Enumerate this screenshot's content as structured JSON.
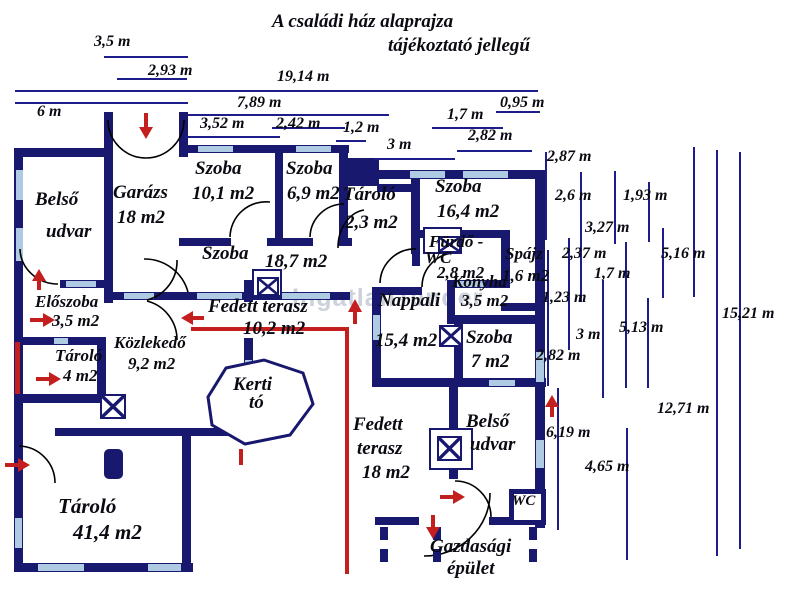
{
  "title": {
    "line1": "A családi ház alaprajza",
    "line2": "tájékoztató jellegű"
  },
  "watermark": "IngatlanTender",
  "colors": {
    "wall": "#18186e",
    "window": "#aecbe3",
    "red_accent": "#c41f1f",
    "text": "#0a0a12",
    "dimension_line": "#1c1c8a",
    "watermark": "#ccd2dc"
  },
  "rooms": {
    "belso_udvar_top": {
      "line1": "Belső",
      "line2": "udvar"
    },
    "garazs": {
      "line1": "Garázs",
      "line2": "18 m2"
    },
    "szoba101": {
      "line1": "Szoba",
      "line2": "10,1 m2"
    },
    "szoba69": {
      "line1": "Szoba",
      "line2": "6,9 m2"
    },
    "tarolo23": {
      "line1": "Tároló",
      "line2": "2,3 m2"
    },
    "szoba164": {
      "line1": "Szoba",
      "line2": "16,4 m2"
    },
    "szoba187": {
      "line1": "Szoba",
      "line2": "18,7 m2"
    },
    "furdo_wc": {
      "line1": "Fürdő -",
      "line2": "WC",
      "line3": "2,8 m2"
    },
    "spajz": {
      "line1": "Spájz",
      "line2": "1,6 m2"
    },
    "konyha": {
      "line1": "Konyha",
      "line2": "3,5 m2"
    },
    "eloszoba": {
      "line1": "Előszoba",
      "line2": "3,5 m2"
    },
    "tarolo4": {
      "line1": "Tároló",
      "line2": "4 m2"
    },
    "kozlekedo": {
      "line1": "Közlekedő",
      "line2": "9,2 m2"
    },
    "fedett_terasz_102": {
      "line1": "Fedett terasz",
      "line2": "10,2 m2"
    },
    "nappali": {
      "line1": "Nappali",
      "line2": "15,4 m2"
    },
    "szoba7": {
      "line1": "Szoba",
      "line2": "7 m2"
    },
    "kerti_to": {
      "line1": "Kerti",
      "line2": "tó"
    },
    "fedett_terasz_18": {
      "line1": "Fedett",
      "line2": "terasz",
      "line3": "18 m2"
    },
    "belso_udvar_bottom": {
      "line1": "Belső",
      "line2": "udvar"
    },
    "tarolo414": {
      "line1": "Tároló",
      "line2": "41,4 m2"
    },
    "wc": {
      "line1": "WC"
    },
    "gazdasagi": {
      "line1": "Gazdasági",
      "line2": "épület"
    }
  },
  "dims_top": {
    "d1": "3,5 m",
    "d2": "2,93 m",
    "d3": "19,14 m",
    "d4": "7,89 m",
    "d5": "6 m",
    "d6": "3,52 m",
    "d7": "2,42 m",
    "d8": "1,2 m",
    "d9": "3 m",
    "d10": "1,7 m",
    "d11": "0,95 m",
    "d12": "2,82 m"
  },
  "dims_right": {
    "r1": "2,87 m",
    "r2": "2,6 m",
    "r3": "1,93 m",
    "r4": "3,27 m",
    "r5": "5,16 m",
    "r6": "2,37 m",
    "r7": "1,7 m",
    "r8": "1,23 m",
    "r9": "3 m",
    "r10": "5,13 m",
    "r11": "15,21 m",
    "r12": "2,82 m",
    "r13": "12,71 m",
    "r14": "6,19 m",
    "r15": "4,65 m"
  }
}
